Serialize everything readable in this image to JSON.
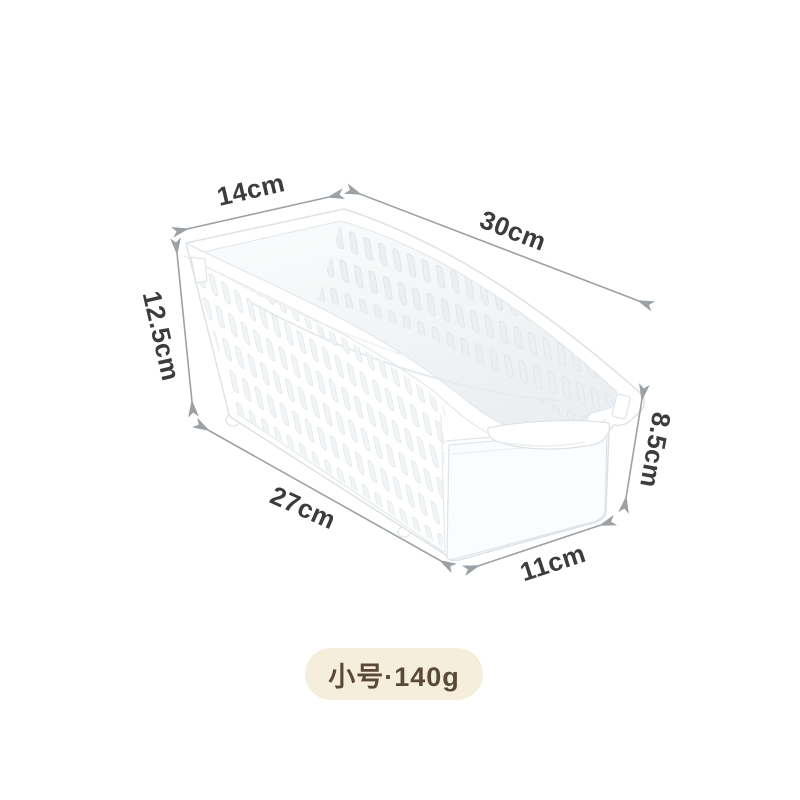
{
  "product_diagram": {
    "dimensions": {
      "top_width": {
        "label": "14cm"
      },
      "top_length": {
        "label": "30cm"
      },
      "back_height": {
        "label": "12.5cm"
      },
      "bottom_length": {
        "label": "27cm"
      },
      "front_height": {
        "label": "8.5cm"
      },
      "bottom_width": {
        "label": "11cm"
      }
    },
    "badge": {
      "label": "小号·140g"
    },
    "colors": {
      "background": "#ffffff",
      "dimension_text": "#3a3c3d",
      "arrow": "#9ba1a5",
      "basket_outline": "#dee2e5",
      "badge_background": "#f6eedc",
      "badge_text": "#5a4936"
    }
  }
}
